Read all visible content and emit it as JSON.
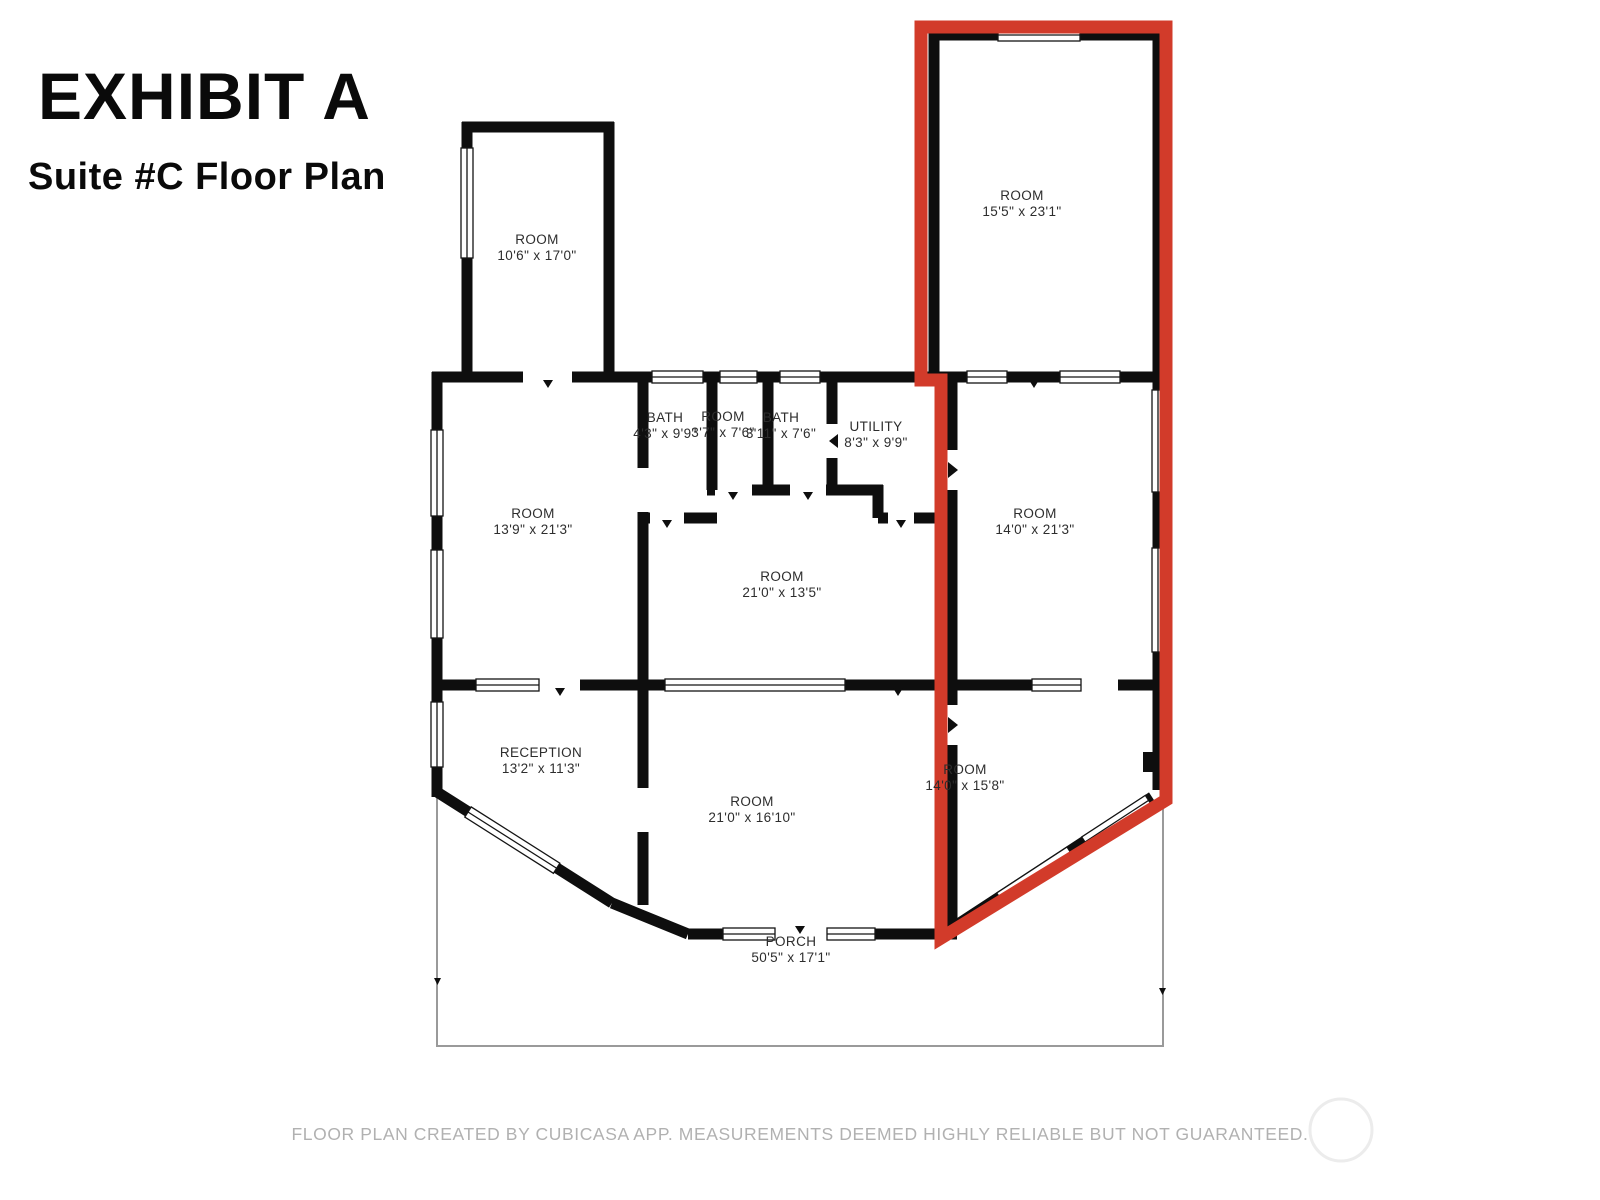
{
  "title": "EXHIBIT A",
  "subtitle": "Suite #C Floor Plan",
  "footer": "FLOOR PLAN CREATED BY CUBICASA APP. MEASUREMENTS DEEMED HIGHLY RELIABLE BUT NOT GUARANTEED.",
  "colors": {
    "suite_outline": "#d23b2a",
    "walls": "#0e0e0e",
    "window_frame": "#141414",
    "porch_line": "#9a9a9a",
    "footer_text": "#b1b1b1",
    "watermark_circle": "#ececec",
    "background": "#ffffff"
  },
  "rooms": {
    "top_left_room": {
      "name": "ROOM",
      "dims": "10'6\" x 17'0\""
    },
    "suite_room_top": {
      "name": "ROOM",
      "dims": "15'5\" x 23'1\""
    },
    "left_room": {
      "name": "ROOM",
      "dims": "13'9\" x 21'3\""
    },
    "bath_1": {
      "name": "BATH",
      "dims": "4'3\" x 9'9\""
    },
    "small_room": {
      "name": "ROOM",
      "dims": "3'7\" x 7'6\""
    },
    "bath_2": {
      "name": "BATH",
      "dims": "3'11\" x 7'6\""
    },
    "utility": {
      "name": "UTILITY",
      "dims": "8'3\" x 9'9\""
    },
    "center_room": {
      "name": "ROOM",
      "dims": "21'0\" x 13'5\""
    },
    "suite_room_middle": {
      "name": "ROOM",
      "dims": "14'0\" x 21'3\""
    },
    "reception": {
      "name": "RECEPTION",
      "dims": "13'2\" x 11'3\""
    },
    "bottom_center_room": {
      "name": "ROOM",
      "dims": "21'0\" x 16'10\""
    },
    "suite_room_bottom": {
      "name": "ROOM",
      "dims": "14'0\" x 15'8\""
    },
    "porch": {
      "name": "PORCH",
      "dims": "50'5\" x 17'1\""
    }
  }
}
